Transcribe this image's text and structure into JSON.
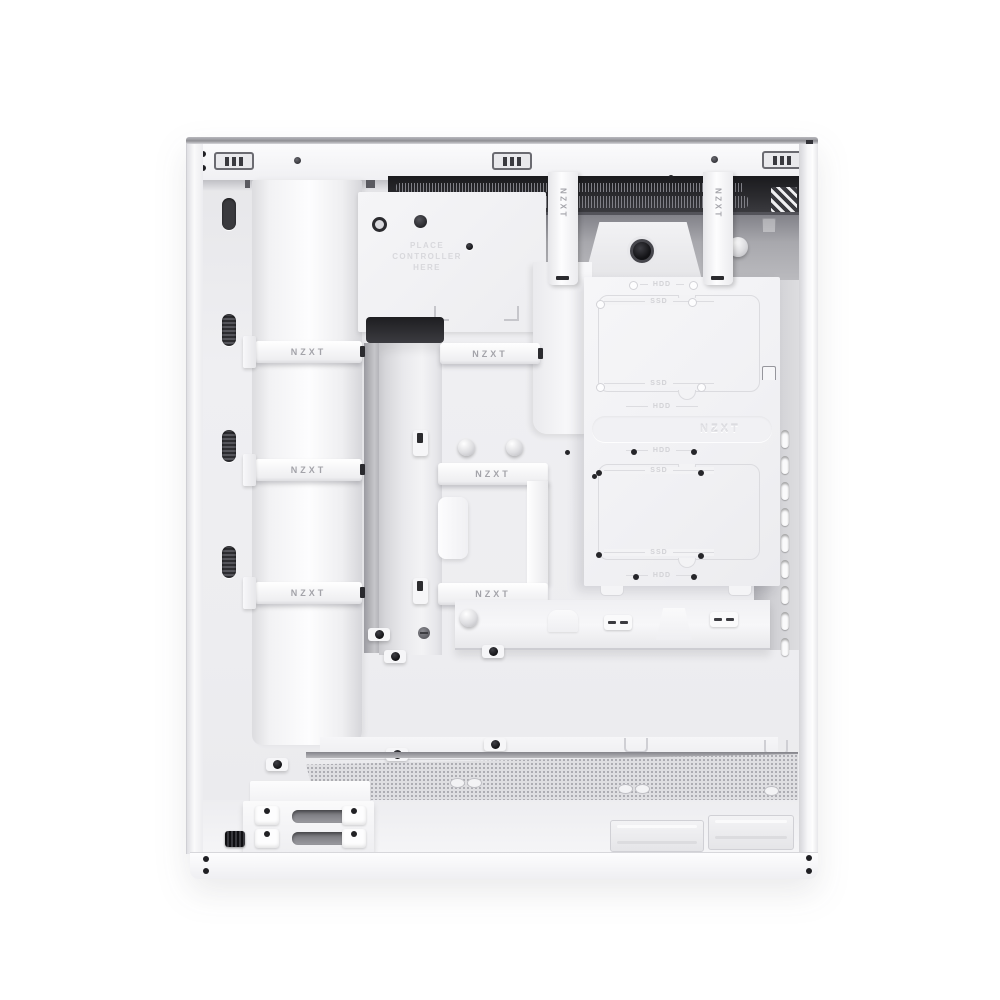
{
  "product": {
    "brand": "NZXT"
  },
  "colors": {
    "background": "#ffffff",
    "case_shell": "#f4f4f6",
    "interior_panel": "#ededf0",
    "top_recess_dark": "#2b2b2e",
    "metal_grey": "#a8a8ad",
    "embossed_text": "#d6d6da",
    "screw_black": "#1d1d1f"
  },
  "labels": {
    "strap": "NZXT",
    "embossed_logo": "NZXT",
    "controller_hint_line1": "PLACE",
    "controller_hint_line2": "CONTROLLER",
    "controller_hint_line3": "HERE",
    "ssd": "SSD",
    "hdd": "HDD"
  }
}
